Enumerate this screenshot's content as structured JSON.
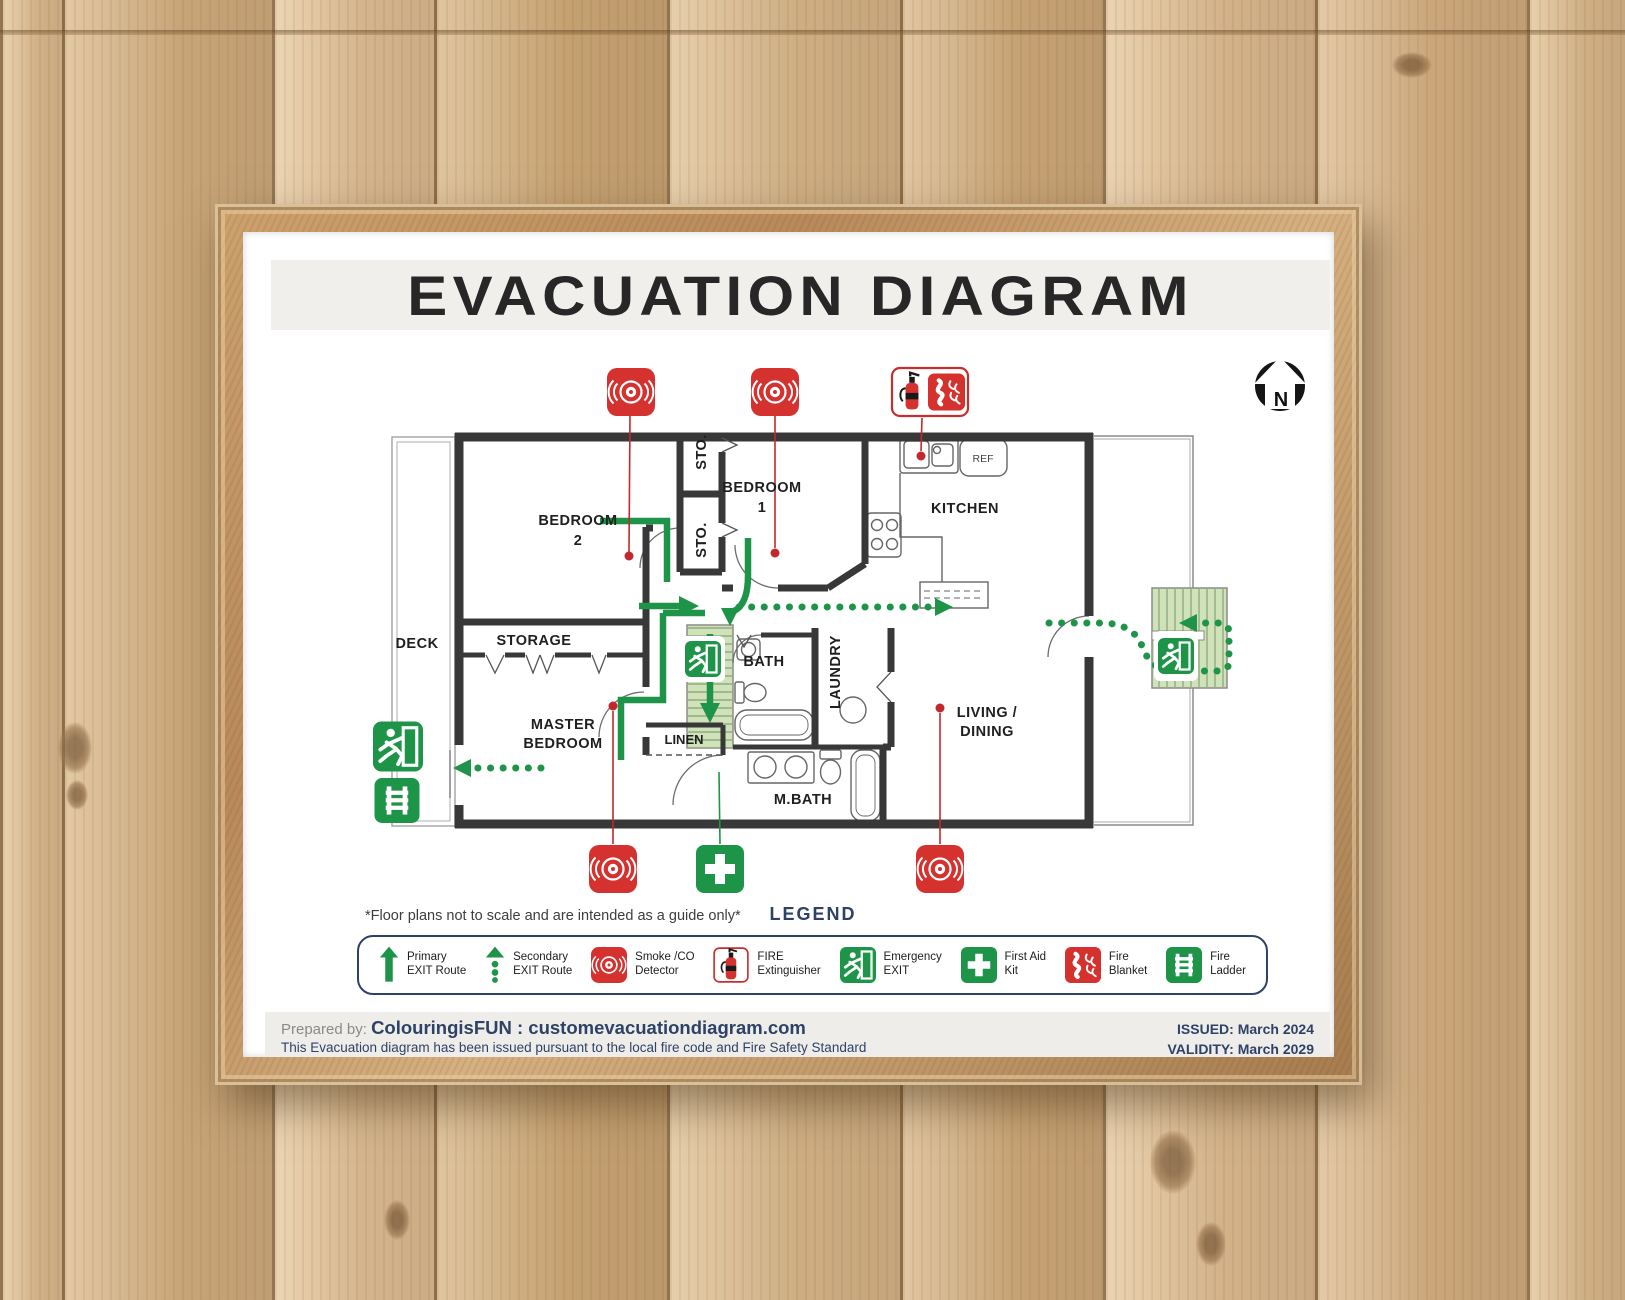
{
  "poster": {
    "title": "EVACUATION DIAGRAM",
    "north_label": "N",
    "note": "*Floor plans not to scale and are intended as a guide only*",
    "rooms": {
      "bedroom2_l1": "BEDROOM",
      "bedroom2_l2": "2",
      "sto_upper": "STO.",
      "sto_lower": "STO.",
      "bedroom1_l1": "BEDROOM",
      "bedroom1_l2": "1",
      "kitchen": "KITCHEN",
      "ref": "REF",
      "deck": "DECK",
      "storage": "STORAGE",
      "master_l1": "MASTER",
      "master_l2": "BEDROOM",
      "bath": "BATH",
      "laundry": "LAUNDRY",
      "living_l1": "LIVING /",
      "living_l2": "DINING",
      "linen": "LINEN",
      "mbath": "M.BATH"
    },
    "legend": {
      "title": "LEGEND",
      "items": [
        {
          "id": "primary-exit-route",
          "line1": "Primary",
          "line2": "EXIT Route"
        },
        {
          "id": "secondary-exit-route",
          "line1": "Secondary",
          "line2": "EXIT Route"
        },
        {
          "id": "smoke-co-detector",
          "line1": "Smoke /CO",
          "line2": "Detector"
        },
        {
          "id": "fire-extinguisher",
          "line1": "FIRE",
          "line2": "Extinguisher"
        },
        {
          "id": "emergency-exit",
          "line1": "Emergency",
          "line2": "EXIT"
        },
        {
          "id": "first-aid-kit",
          "line1": "First Aid",
          "line2": "Kit"
        },
        {
          "id": "fire-blanket",
          "line1": "Fire",
          "line2": "Blanket"
        },
        {
          "id": "fire-ladder",
          "line1": "Fire",
          "line2": "Ladder"
        }
      ]
    },
    "footer": {
      "prepared_label": "Prepared by:",
      "prepared_value": "ColouringisFUN : customevacuationdiagram.com",
      "compliance": "This Evacuation diagram has been issued pursuant to the local fire code and Fire Safety Standard",
      "issued": "ISSUED: March 2024",
      "validity": "VALIDITY: March 2029"
    },
    "colors": {
      "accent_green": "#1e9448",
      "accent_red": "#d5312e",
      "navy": "#2e4266",
      "wall": "#383838"
    }
  }
}
